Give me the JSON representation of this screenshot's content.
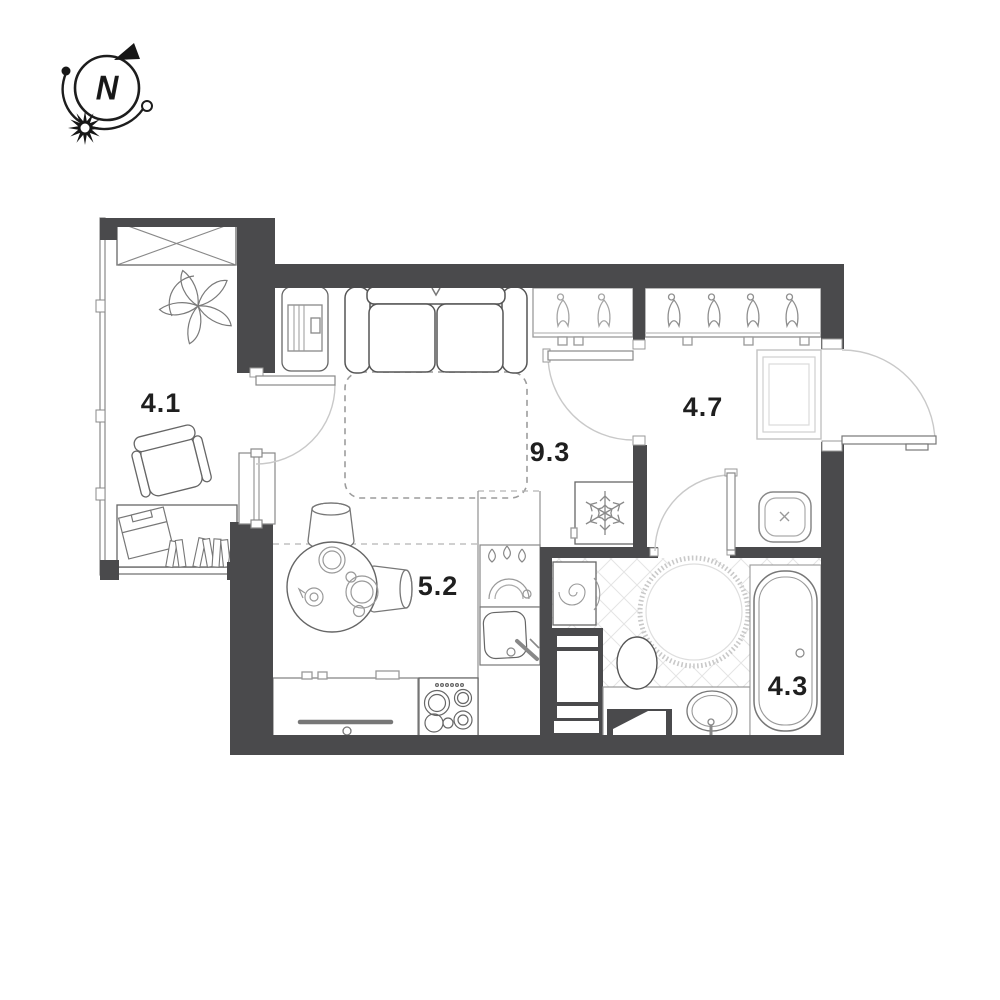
{
  "title": "Studio apartment floor plan",
  "compass": {
    "label": "N"
  },
  "rooms": [
    {
      "id": "balcony",
      "area": "4.1"
    },
    {
      "id": "living-room",
      "area": "9.3"
    },
    {
      "id": "hallway",
      "area": "4.7"
    },
    {
      "id": "kitchen",
      "area": "5.2"
    },
    {
      "id": "bathroom",
      "area": "4.3"
    }
  ],
  "colors": {
    "wall": "#4a4a4c",
    "furniture_line": "#666666",
    "light_line": "#9c9c9c",
    "label": "#1f1f1f",
    "floor_hatch": "#e4e4e4"
  },
  "fixtures": {
    "balcony": [
      "crossed-storage-box",
      "plant",
      "armchair",
      "desk",
      "laptop",
      "books"
    ],
    "living": [
      "tv-stand",
      "sofa",
      "fold-out-bed-dashed",
      "round-dining-table",
      "two-chairs",
      "wardrobe-two-hangers"
    ],
    "kitchen": [
      "drawer-cabinet",
      "stove-4-burners",
      "sink",
      "dishwasher-drops",
      "refrigerator-snowflake"
    ],
    "hallway": [
      "wardrobe-four-hangers",
      "mirror",
      "utility-shaft-x"
    ],
    "bathroom": [
      "washing-machine-spiral",
      "shelf-unit",
      "toilet",
      "round-rug",
      "vanity-basin",
      "bathtub",
      "tile-hatch-floor"
    ]
  }
}
